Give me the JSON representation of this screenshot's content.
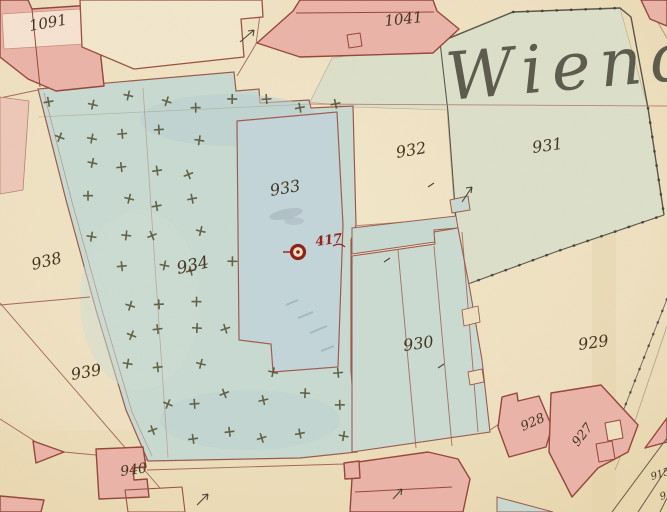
{
  "map": {
    "kind": "historical-cadastral-map",
    "script_label": {
      "text": "Wiend",
      "x": 448,
      "y": 100,
      "rot": -5,
      "size": 66,
      "color": "#4a483c"
    },
    "parcel_labels": [
      {
        "text": "1091",
        "x": 30,
        "y": 31,
        "rot": -10,
        "size": 15
      },
      {
        "text": "1041",
        "x": 385,
        "y": 26,
        "rot": -6,
        "size": 15
      },
      {
        "text": "932",
        "x": 397,
        "y": 158,
        "rot": -10,
        "size": 16
      },
      {
        "text": "931",
        "x": 533,
        "y": 153,
        "rot": -8,
        "size": 16
      },
      {
        "text": "933",
        "x": 271,
        "y": 196,
        "rot": -10,
        "size": 16
      },
      {
        "text": "934",
        "x": 178,
        "y": 274,
        "rot": -12,
        "size": 17
      },
      {
        "text": "938",
        "x": 33,
        "y": 270,
        "rot": -14,
        "size": 16
      },
      {
        "text": "939",
        "x": 72,
        "y": 380,
        "rot": -10,
        "size": 16
      },
      {
        "text": "940",
        "x": 121,
        "y": 476,
        "rot": -8,
        "size": 14
      },
      {
        "text": "930",
        "x": 404,
        "y": 351,
        "rot": -8,
        "size": 16
      },
      {
        "text": "929",
        "x": 579,
        "y": 350,
        "rot": -8,
        "size": 16
      },
      {
        "text": "928",
        "x": 523,
        "y": 431,
        "rot": -24,
        "size": 13
      },
      {
        "text": "927",
        "x": 578,
        "y": 447,
        "rot": -52,
        "size": 13
      },
      {
        "text": "915",
        "x": 652,
        "y": 480,
        "rot": -18,
        "size": 10
      },
      {
        "text": "916",
        "x": 661,
        "y": 500,
        "rot": -18,
        "size": 10
      }
    ],
    "benchmark": {
      "symbol": "circled-dot",
      "text": "417",
      "x": 316,
      "y": 246,
      "rot": -8,
      "size": 13,
      "color": "#971f1a"
    },
    "tree_symbol": {
      "glyph": "+",
      "meaning": "orchard-tree-mark"
    },
    "palette": {
      "paper": "#efe1c1",
      "building_pink": "#ecb4aa",
      "building_outline": "#964538",
      "orchard_teal": "#c9dbd3",
      "garden_blue": "#c3d6db",
      "field_green": "#dde0ca",
      "courtyard_teal": "#c8dad2",
      "ink": "#42351f",
      "red_ink": "#971f1a",
      "line_red": "#a5655c",
      "boundary_dark": "#57554a",
      "tree_mark": "#4f4a2c"
    }
  }
}
